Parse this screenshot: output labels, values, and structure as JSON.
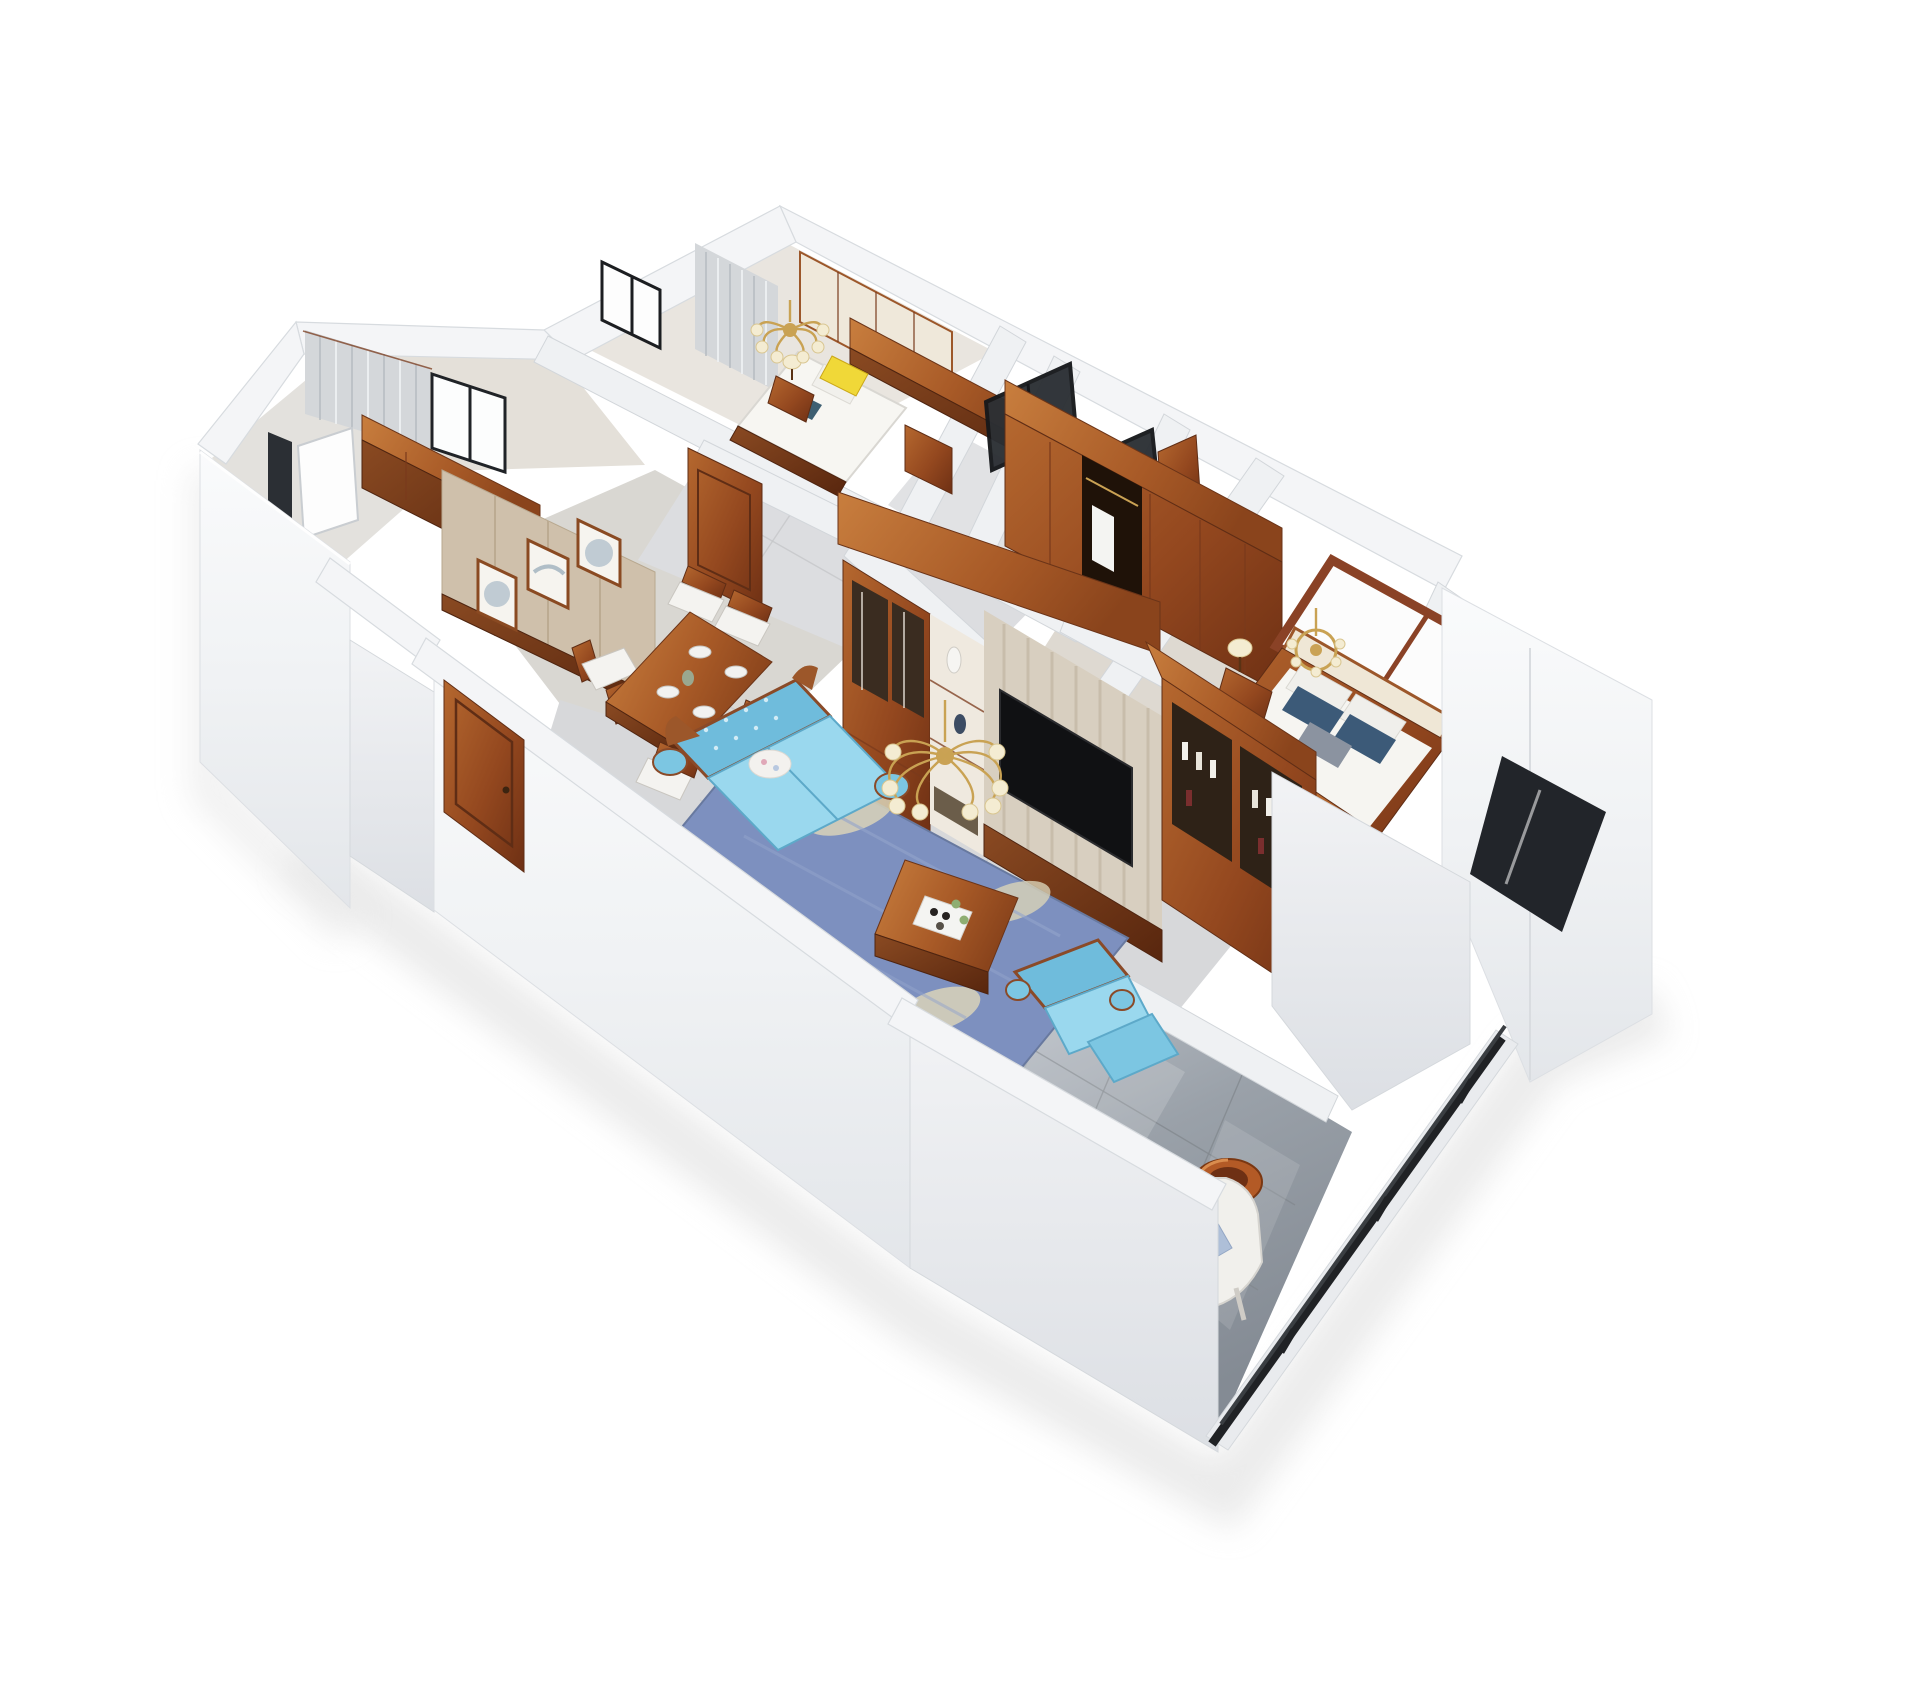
{
  "scene": {
    "type": "3d-floorplan-render",
    "style": "dollhouse cutaway aerial view, white walls, chinese-american classic wood furniture",
    "background": "#ffffff"
  },
  "palette": {
    "wall_top": "#f4f5f7",
    "wall_edge": "#d7dbdf",
    "wood": "#9c572a",
    "wood_dark": "#6e3418",
    "wood_light": "#c07a42",
    "floor_tile": "#d8d8da",
    "floor_warm": "#ddd6cc",
    "balcony_tile": "#9aa1a9",
    "sofa_blue": "#9ad8ee",
    "sofa_blue_deep": "#6fbcdc",
    "rug_blue": "#7d90bf",
    "rug_leaf": "#d9d3b8",
    "pillow_yellow": "#f0d838",
    "pillow_navy": "#3c5a78",
    "curtain": "#d4d7da",
    "glass_dark": "#2b2f34",
    "railing": "#202225",
    "gold": "#c9a253",
    "cream": "#f2ead6",
    "art_beige": "#cfc0ab",
    "tv_black": "#101113"
  },
  "counts": {
    "art_frames": 3,
    "dining_chairs": 6,
    "living_chandelier_shades": 8,
    "bedroom_chandelier_shades": 6,
    "master_pillows": 5,
    "tv_screens": 1,
    "glass_doors": 2
  },
  "rooms": [
    {
      "id": "bedroom-top",
      "name": "secondary bedroom",
      "items": [
        "double bed with yellow accent pillow",
        "teal pillow",
        "wood nightstand with table lamp",
        "brass chandelier with cream shades",
        "built-in wardrobe with cream panels",
        "wood desk top",
        "gray curtains",
        "black framed window"
      ]
    },
    {
      "id": "study",
      "name": "study room",
      "items": [
        "gray curtains on two walls",
        "black framed windows",
        "beige panel wall"
      ]
    },
    {
      "id": "utility",
      "name": "utility room",
      "items": [
        "white window opening",
        "wood sideboard cabinet"
      ]
    },
    {
      "id": "dining",
      "name": "dining room",
      "items": [
        "wood dining table with place settings",
        "six wood chairs with white cushions",
        "three framed ink artworks",
        "beige paneled feature wall",
        "wood interior door"
      ]
    },
    {
      "id": "hallway",
      "name": "hallway",
      "items": [
        "light tiled floor",
        "wood door"
      ]
    },
    {
      "id": "bathrooms",
      "name": "bathrooms",
      "items": [
        "black framed glass sliding door",
        "black framed glass partition"
      ]
    },
    {
      "id": "master-bedroom",
      "name": "master bedroom",
      "items": [
        "wood framed bed",
        "cream headboard panels",
        "navy gray and white pillows",
        "open wardrobe with hanging clothes",
        "nightstand with cream lamp",
        "brass chandelier",
        "wood framed window",
        "white bay window volume with dark opening"
      ]
    },
    {
      "id": "living",
      "name": "living room",
      "items": [
        "light blue tufted sofa with carved wood trim",
        "light blue armchair",
        "wood coffee table with tea tray",
        "blue leaf pattern rug",
        "brass chandelier with cream shades",
        "full wall wood tv unit",
        "glass display cabinet",
        "shelf niche with vases",
        "black flat screen tv on striped beige panel",
        "wine cabinet with bottles"
      ]
    },
    {
      "id": "balcony",
      "name": "balcony",
      "items": [
        "glossy gray floor tiles",
        "white lounge chair with two pillows",
        "round wood stand",
        "black metal railing"
      ]
    }
  ]
}
